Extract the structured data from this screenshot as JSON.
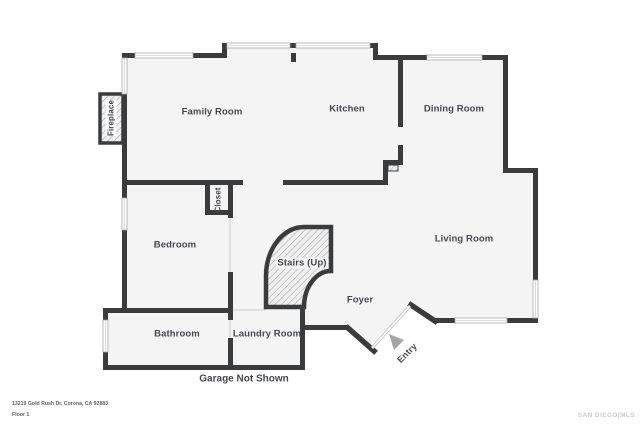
{
  "rooms": {
    "family_room": "Family Room",
    "kitchen": "Kitchen",
    "dining_room": "Dining Room",
    "bedroom": "Bedroom",
    "living_room": "Living Room",
    "stairs": "Stairs (Up)",
    "foyer": "Foyer",
    "bathroom": "Bathroom",
    "laundry_room": "Laundry Room",
    "closet": "Closet",
    "fireplace": "Fireplace",
    "entry": "Entry"
  },
  "annotations": {
    "garage_note": "Garage Not Shown"
  },
  "footer": {
    "address": "13219 Gold Rush Dr, Corona, CA 92883",
    "floor": "Floor 1",
    "watermark": "SAN DIEGO|MLS"
  },
  "colors": {
    "wall": "#3a3b3d",
    "floor": "#f4f4f5",
    "label": "#45484f",
    "hatch_line": "#a6a6a6",
    "window_edge": "#a8a8a8",
    "entry_arrow": "#a6a6a6",
    "watermark": "#cbcbcb"
  }
}
